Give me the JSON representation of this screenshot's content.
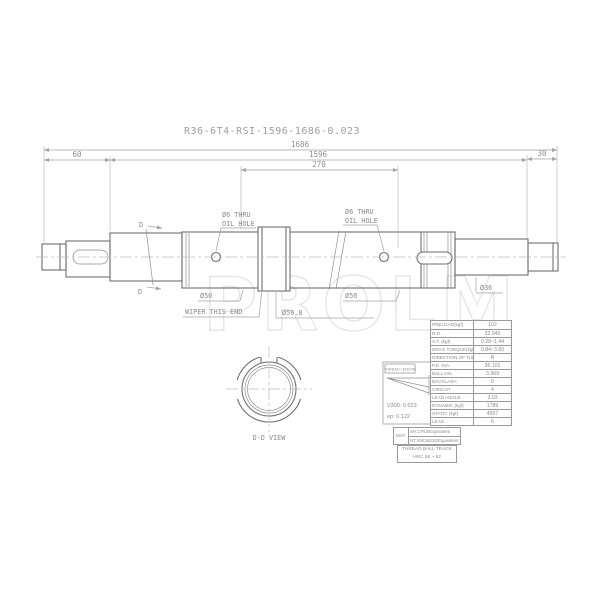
{
  "title": "R36-6T4-RSI-1596-1686-0.023",
  "watermark": "PROLM",
  "dimensions": {
    "overall": "1686",
    "thread": "1596",
    "mid": "270",
    "left_end": "60",
    "right_end": "30"
  },
  "annotations": {
    "oil_hole_left_1": "Ø6 THRU",
    "oil_hole_left_2": "OIL HOLE",
    "oil_hole_right_1": "Ø6 THRU",
    "oil_hole_right_2": "OIL HOLE",
    "dia_50_left": "Ø50",
    "dia_50_right": "Ø50",
    "dia_59_8": "Ø59.8",
    "dia_36": "Ø36",
    "wiper": "WIPER THIS END",
    "section_d_top": "D",
    "section_d_bottom": "D",
    "section_view_label": "D-D VIEW"
  },
  "accuracy_box": {
    "header": "THREAD LENGTH",
    "v300": "V300: 0.023",
    "ep": "ep: 0.122"
  },
  "spec_table": {
    "rows": [
      {
        "label": "PRELOAD(kgf)",
        "value": "102"
      },
      {
        "label": "R.D.",
        "value": "32.045"
      },
      {
        "label": "S.F.  (kgf)",
        "value": "0.28~1.44"
      },
      {
        "label": "DRAG TORQUE(kgf-m)",
        "value": "0.84~3.60"
      },
      {
        "label": "DIRECTION OF TURN",
        "value": "R"
      },
      {
        "label": "P.E. DIA.",
        "value": "36.101"
      },
      {
        "label": "BALL DIA.",
        "value": "3.969"
      },
      {
        "label": "BACKLASH",
        "value": "0"
      },
      {
        "label": "CIRCUIT",
        "value": "4"
      },
      {
        "label": "LEAD ANGLE",
        "value": "3.03"
      },
      {
        "label": "DYNAMIC  (kgf)",
        "value": "1789"
      },
      {
        "label": "STATIC  (kgf)",
        "value": "4957"
      },
      {
        "label": "LEAD",
        "value": "6"
      }
    ]
  },
  "material_table": {
    "mat_label": "MAT.",
    "shaft": "SH.CF53/Equivalent",
    "nut": "NT.SNCM220/Equivalent",
    "hardness_1": "THREAD BALL TRACK",
    "hardness_2": "HRC 56 ~ 62"
  },
  "colors": {
    "line": "#6e6e6e",
    "dimension": "#a3a3a3",
    "text": "#8a8a8a",
    "watermark": "#e6e6e6",
    "background": "#ffffff"
  }
}
